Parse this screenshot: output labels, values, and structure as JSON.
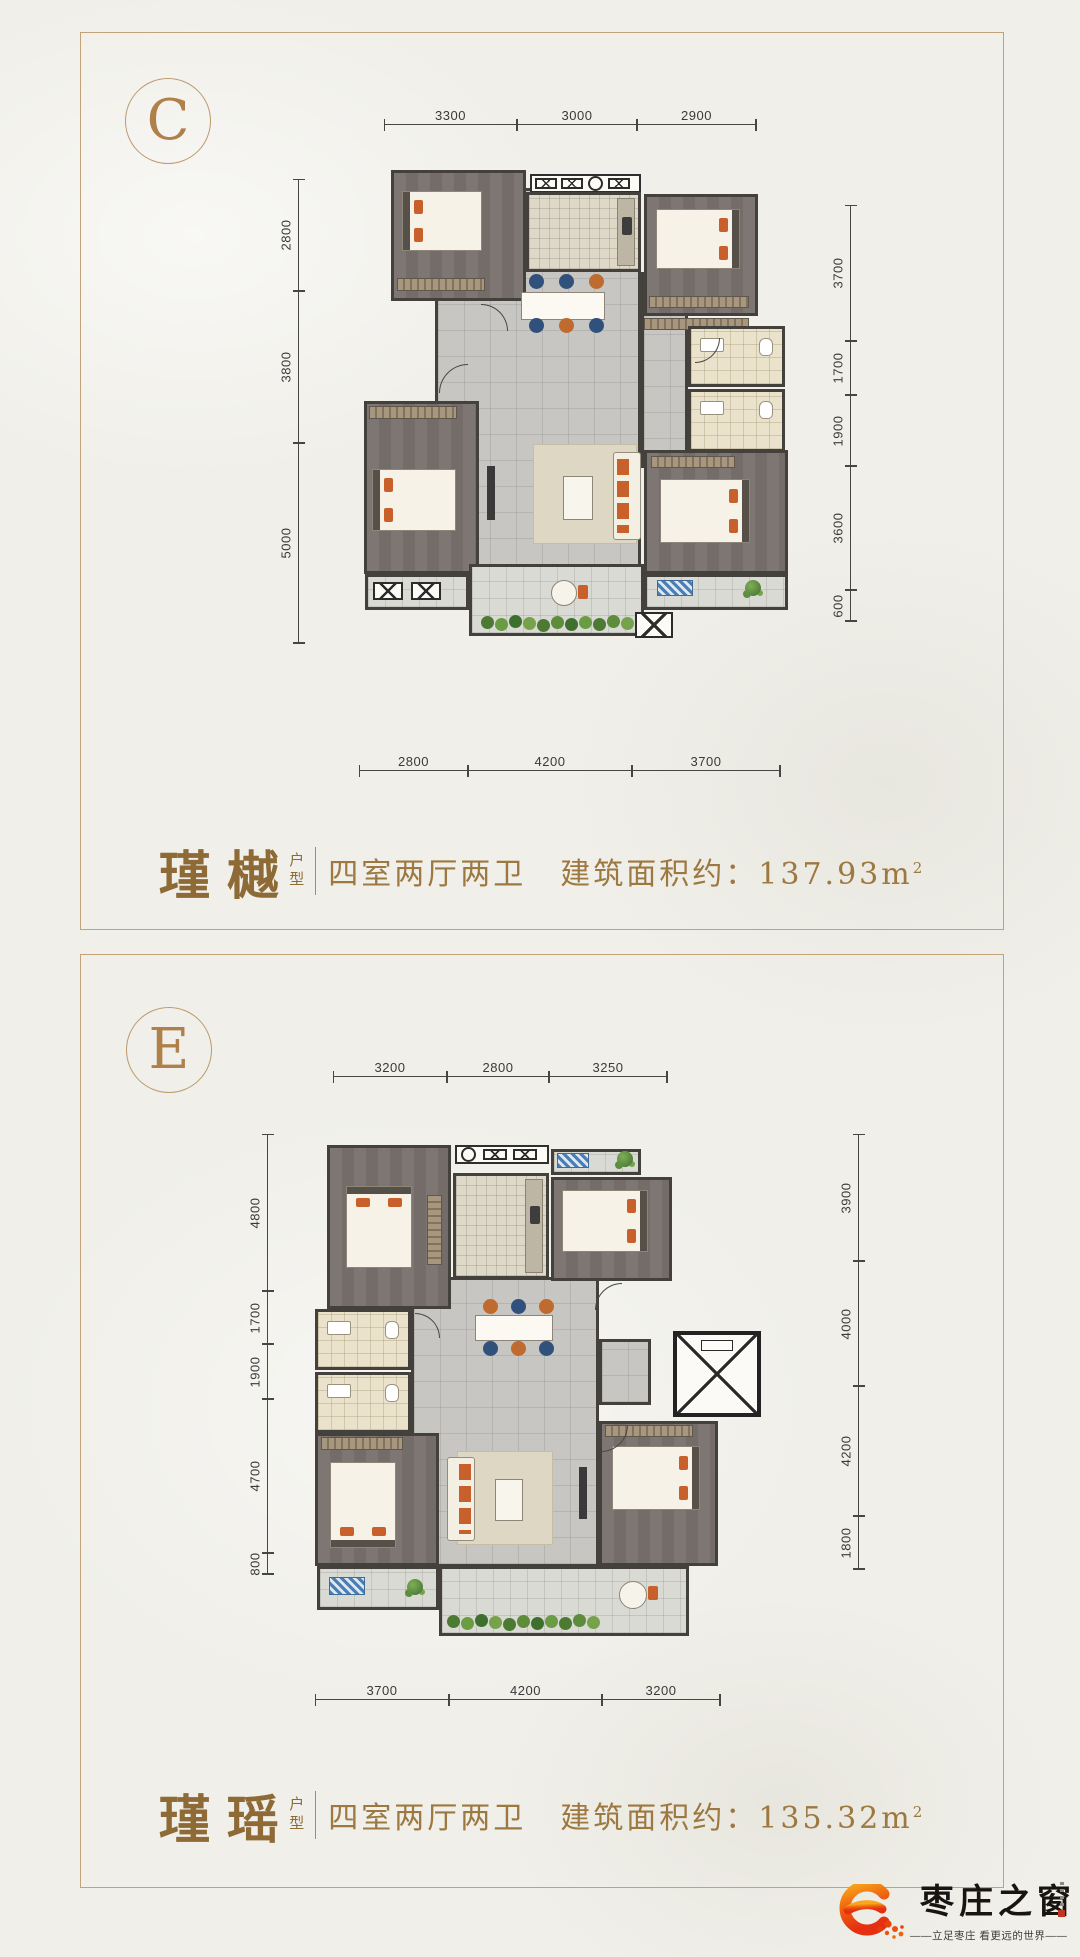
{
  "panels": [
    {
      "letter": "C",
      "plan_name": "瑾樾",
      "plan_name_suffix": "户型",
      "layout": "四室两厅两卫",
      "area_label": "建筑面积约：",
      "area_value": "137.93",
      "area_unit": "m",
      "area_sup": "2",
      "dims": {
        "top": [
          "3300",
          "3000",
          "2900"
        ],
        "left": [
          "2800",
          "3800",
          "5000"
        ],
        "right": [
          "3700",
          "1700",
          "1900",
          "3600",
          "600"
        ],
        "bottom": [
          "2800",
          "4200",
          "3700"
        ]
      }
    },
    {
      "letter": "E",
      "plan_name": "瑾瑶",
      "plan_name_suffix": "户型",
      "layout": "四室两厅两卫",
      "area_label": "建筑面积约：",
      "area_value": "135.32",
      "area_unit": "m",
      "area_sup": "2",
      "dims": {
        "top": [
          "3200",
          "2800",
          "3250"
        ],
        "left": [
          "4800",
          "1700",
          "1900",
          "4700",
          "800"
        ],
        "right": [
          "3900",
          "4000",
          "4200",
          "1800"
        ],
        "bottom": [
          "3700",
          "4200",
          "3200"
        ]
      }
    }
  ],
  "logo": {
    "brand": "枣庄之窗",
    "tagline": "——立足枣庄  看更远的世界——"
  },
  "colors": {
    "panel_border": "#c3a179",
    "title_brown": "#8e6b36",
    "text_brown": "#9d7840",
    "dim_text": "#3a3a3a",
    "wall": "#44403c",
    "accent_orange": "#c8602b",
    "logo_orange": "#e84b10",
    "paper": "#f0efe9"
  }
}
